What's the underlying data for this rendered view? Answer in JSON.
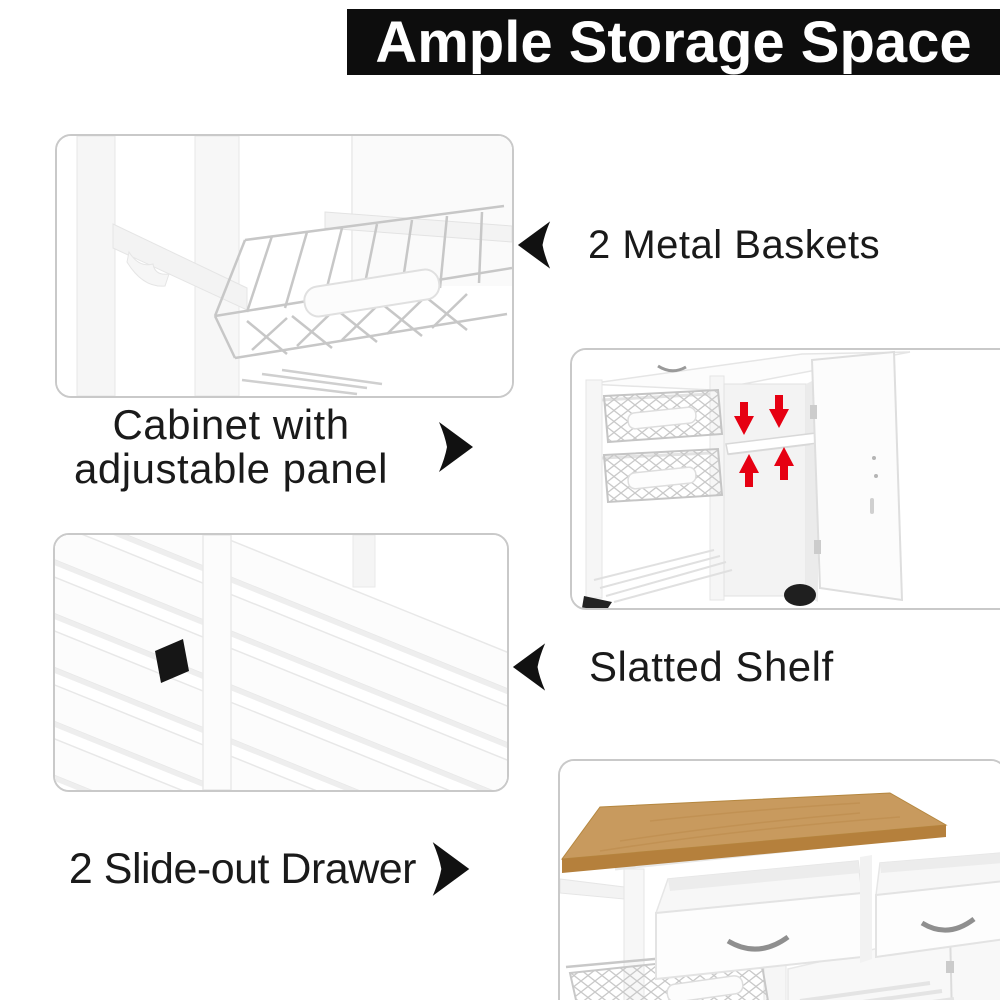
{
  "title": {
    "text": "Ample Storage Space"
  },
  "callouts": [
    {
      "label": "2 Metal Baskets",
      "arrow_direction": "left"
    },
    {
      "label_line1": "Cabinet with",
      "label_line2": "adjustable panel",
      "arrow_direction": "right"
    },
    {
      "label": "Slatted Shelf",
      "arrow_direction": "left"
    },
    {
      "label": "2 Slide-out Drawer",
      "arrow_direction": "right"
    }
  ],
  "photos": [
    {
      "name": "metal-baskets-photo",
      "alt": "pull-out metal wire basket on white cart"
    },
    {
      "name": "cabinet-photo",
      "alt": "open cabinet with adjustable shelf panel marked by red arrows"
    },
    {
      "name": "slatted-shelf-photo",
      "alt": "white slatted bottom shelf"
    },
    {
      "name": "drawers-photo",
      "alt": "two open slide-out drawers under wooden top"
    }
  ],
  "colors": {
    "title_bg": "#0d0d0d",
    "title_text": "#ffffff",
    "ink": "#1a1a1a",
    "accent_red": "#e60012",
    "wood": "#c89a5e",
    "photo_border": "#c9c9c9"
  }
}
